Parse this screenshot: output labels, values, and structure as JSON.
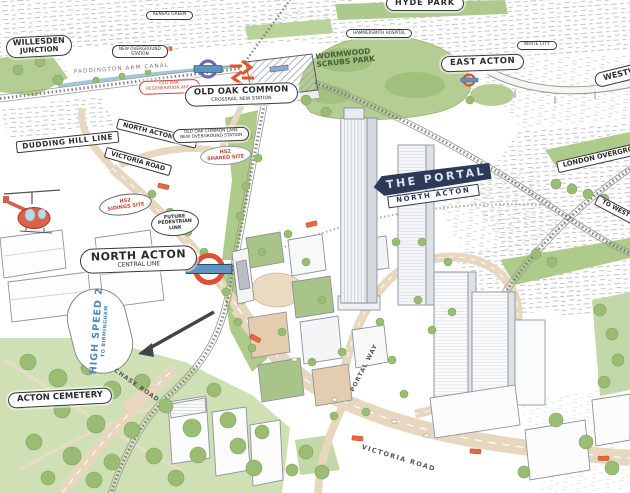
{
  "labels": {
    "willesden_junction": {
      "line1": "WILLESDEN",
      "line2": "JUNCTION"
    },
    "kensal_green": {
      "text": "KENSAL GREEN"
    },
    "new_overground_station": {
      "line1": "NEW OVERGROUND",
      "line2": "STATION"
    },
    "paddington_arm_canal": {
      "text": "PADDINGTON ARM CANAL"
    },
    "old_oak_regeneration_area": {
      "line1": "OLD OAK",
      "line2": "REGENERATION AREA"
    },
    "old_oak_common_station": {
      "line1": "OLD OAK COMMON",
      "line2": "CROSSRAIL NEW STATION"
    },
    "hyde_park": {
      "text": "HYDE PARK"
    },
    "hammersmith_hospital": {
      "text": "HAMMERSMITH HOSPITAL"
    },
    "wormwood_scrubs_park": {
      "line1": "WORMWOOD",
      "line2": "SCRUBS PARK"
    },
    "east_acton": {
      "text": "EAST ACTON"
    },
    "white_city": {
      "text": "WHITE CITY"
    },
    "westway": {
      "text": "WESTWAY"
    },
    "dudding_hill_line": {
      "text": "DUDDING HILL LINE"
    },
    "north_acton_link": {
      "text": "NORTH ACTON LINK"
    },
    "victoria_road_upper": {
      "text": "VICTORIA ROAD"
    },
    "old_oak_common_lane": {
      "line1": "OLD OAK COMMON LANE",
      "line2": "NEW OVERGROUND STATION"
    },
    "hs2_site_north": {
      "line1": "HS2",
      "line2": "SHARED SITE"
    },
    "hs2_site_south": {
      "line1": "HS2",
      "line2": "SIDINGS SITE"
    },
    "future_pedestrian_link": {
      "line1": "FUTURE",
      "line2": "PEDESTRIAN",
      "line3": "LINK"
    },
    "the_portal_sign": {
      "line1": "THE PORTAL",
      "line2": "NORTH ACTON"
    },
    "london_overground": {
      "text": "LONDON OVERGROUND"
    },
    "to_west": {
      "text": "TO WEST"
    },
    "north_acton_station": {
      "line1": "NORTH ACTON",
      "line2": "CENTRAL LINE"
    },
    "high_speed_2": {
      "line1": "HIGH SPEED 2",
      "line2": "TO BIRMINGHAM"
    },
    "acton_cemetery": {
      "text": "ACTON CEMETERY"
    },
    "chase_road": {
      "text": "CHASE ROAD"
    },
    "portal_way": {
      "text": "PORTAL WAY"
    },
    "victoria_road_lower": {
      "text": "VICTORIA ROAD"
    }
  },
  "icons": {
    "crossrail_roundel": "rail-roundel",
    "national_rail": "national-rail-double-arrow",
    "north_acton_roundel": "tube-roundel",
    "east_acton_roundel": "tube-roundel",
    "helicopter": "helicopter",
    "hs2_arrow": "route-direction-arrow",
    "bus": "london-bus"
  },
  "colors": {
    "portal_sign_navy": "#2c3a58",
    "hs2_text_blue": "#4f87b5",
    "hs2_site_red": "#cc4433",
    "roundel_red": "#dd4f35",
    "roundel_bar_blue": "#5f93c0",
    "crossrail_purple": "#6e6bb0",
    "national_rail_orange": "#e55228",
    "park_green": "#b4cd92",
    "road_beige": "#e7d7bf",
    "bus_orange": "#e8683c"
  }
}
